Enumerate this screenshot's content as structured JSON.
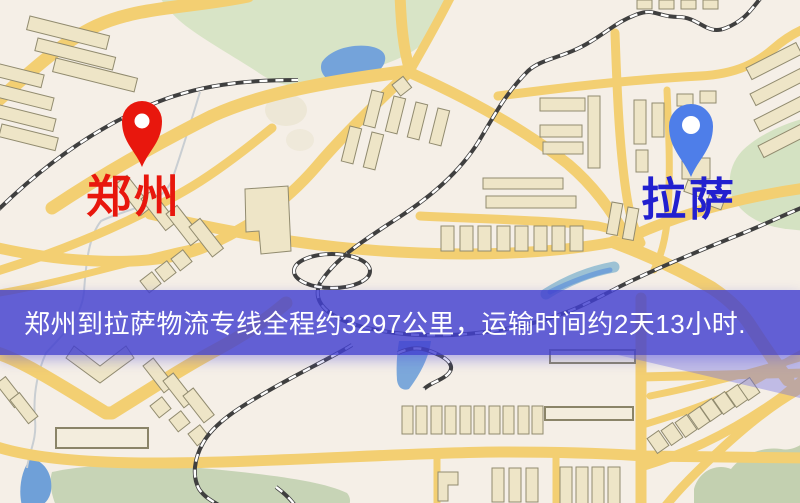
{
  "image": {
    "kind": "logistics-route-map-image",
    "width_px": 800,
    "height_px": 503
  },
  "banner": {
    "text": "郑州到拉萨物流专线全程约3297公里，运输时间约2天13小时.",
    "background_color": "#4240D0",
    "text_color": "#FFFFFF"
  },
  "route": {
    "from": "郑州",
    "to": "拉萨",
    "distance_text": "约3297公里",
    "duration_text": "约2天13小时"
  },
  "markers": {
    "origin": {
      "label": "郑州",
      "pin_color": "#E8170D",
      "label_color": "#E8170D",
      "map_position": "upper-left"
    },
    "destination": {
      "label": "拉萨",
      "pin_color": "#4E7EE9",
      "label_color": "#2220CF",
      "map_position": "upper-right"
    }
  },
  "map_palette": {
    "background": "#F5EFE7",
    "road_yellow": "#F3CF72",
    "park_green": "#D8E4C6",
    "field_green": "#C7D4B6",
    "water_blue": "#74A3DA",
    "river_teal": "#7FB3CE",
    "building_tan": "#EEE5C7",
    "railway_dark": "#3F3F3F"
  }
}
